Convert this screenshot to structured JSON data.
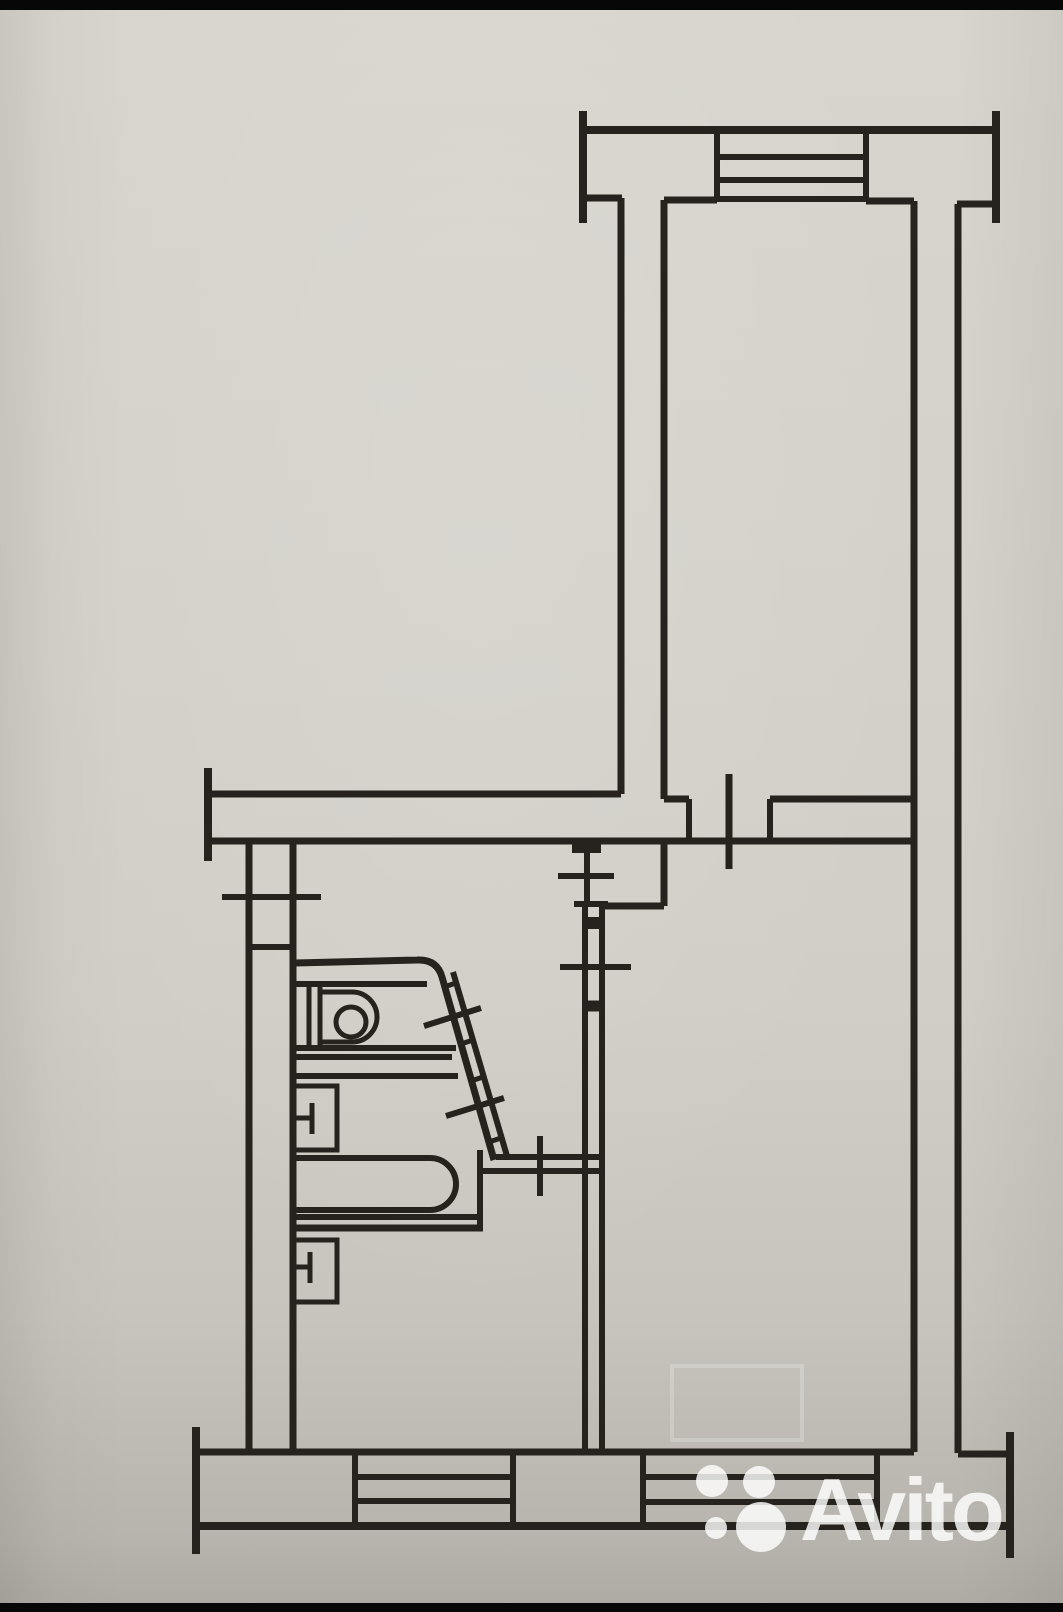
{
  "page": {
    "paper_color": "#d1cec7",
    "ink_color": "#26231e",
    "letterbox_color": "#070707"
  },
  "watermark": {
    "brand_text": "Avito",
    "text_color": "rgba(255,255,255,0.82)",
    "font_size_px": 88,
    "text_left_px": 800,
    "text_top_px": 1466,
    "dots": [
      {
        "name": "avito-dot-top-left",
        "cx": 712,
        "cy": 1481,
        "r": 16
      },
      {
        "name": "avito-dot-top-right",
        "cx": 759,
        "cy": 1482,
        "r": 16
      },
      {
        "name": "avito-dot-bottom-left",
        "cx": 716,
        "cy": 1528,
        "r": 11
      },
      {
        "name": "avito-dot-bottom-right",
        "cx": 761,
        "cy": 1527,
        "r": 25
      }
    ],
    "dot_color": "rgba(255,255,255,0.82)"
  },
  "floorplan": {
    "stroke": "#26231e",
    "elements": [
      {
        "type": "line",
        "name": "top-wall-outer",
        "x1": 583,
        "y1": 130,
        "x2": 997,
        "y2": 130,
        "w": 8
      },
      {
        "type": "line",
        "name": "top-wall-cap-left",
        "x1": 583,
        "y1": 111,
        "x2": 583,
        "y2": 223,
        "w": 8
      },
      {
        "type": "line",
        "name": "top-wall-cap-right",
        "x1": 996,
        "y1": 111,
        "x2": 996,
        "y2": 223,
        "w": 8
      },
      {
        "type": "line",
        "name": "top-wall-inner-a",
        "x1": 584,
        "y1": 198,
        "x2": 622,
        "y2": 198,
        "w": 7
      },
      {
        "type": "line",
        "name": "top-wall-inner-b",
        "x1": 664,
        "y1": 200,
        "x2": 717,
        "y2": 200,
        "w": 7
      },
      {
        "type": "line",
        "name": "window-top-jamb-left",
        "x1": 717,
        "y1": 132,
        "x2": 717,
        "y2": 199,
        "w": 6
      },
      {
        "type": "line",
        "name": "window-top-jamb-right",
        "x1": 866,
        "y1": 132,
        "x2": 866,
        "y2": 200,
        "w": 6
      },
      {
        "type": "line",
        "name": "window-top-line-1",
        "x1": 717,
        "y1": 157,
        "x2": 866,
        "y2": 157,
        "w": 6
      },
      {
        "type": "line",
        "name": "window-top-line-2",
        "x1": 717,
        "y1": 180,
        "x2": 866,
        "y2": 180,
        "w": 6
      },
      {
        "type": "line",
        "name": "window-top-sill",
        "x1": 717,
        "y1": 199,
        "x2": 866,
        "y2": 199,
        "w": 6
      },
      {
        "type": "line",
        "name": "top-wall-inner-c",
        "x1": 866,
        "y1": 201,
        "x2": 914,
        "y2": 201,
        "w": 7
      },
      {
        "type": "line",
        "name": "top-wall-inner-d",
        "x1": 957,
        "y1": 204,
        "x2": 994,
        "y2": 204,
        "w": 7
      },
      {
        "type": "line",
        "name": "room1-west-wall-outer",
        "x1": 621,
        "y1": 198,
        "x2": 621,
        "y2": 794,
        "w": 7
      },
      {
        "type": "line",
        "name": "room1-west-wall-inner",
        "x1": 664,
        "y1": 200,
        "x2": 664,
        "y2": 799,
        "w": 7
      },
      {
        "type": "line",
        "name": "east-wall-inner",
        "x1": 914,
        "y1": 201,
        "x2": 914,
        "y2": 1452,
        "w": 7
      },
      {
        "type": "line",
        "name": "east-wall-outer",
        "x1": 958,
        "y1": 204,
        "x2": 958,
        "y2": 1453,
        "w": 7
      },
      {
        "type": "line",
        "name": "mid-wall-cap-left",
        "x1": 208,
        "y1": 768,
        "x2": 208,
        "y2": 861,
        "w": 8
      },
      {
        "type": "line",
        "name": "mid-wall-top",
        "x1": 210,
        "y1": 794,
        "x2": 621,
        "y2": 794,
        "w": 7
      },
      {
        "type": "line",
        "name": "mid-wall-top-b",
        "x1": 664,
        "y1": 799,
        "x2": 689,
        "y2": 799,
        "w": 7
      },
      {
        "type": "line",
        "name": "mid-wall-top-c",
        "x1": 770,
        "y1": 799,
        "x2": 914,
        "y2": 799,
        "w": 7
      },
      {
        "type": "line",
        "name": "mid-wall-bottom",
        "x1": 210,
        "y1": 841,
        "x2": 914,
        "y2": 841,
        "w": 7
      },
      {
        "type": "line",
        "name": "doorway1-jamb-left",
        "x1": 689,
        "y1": 799,
        "x2": 689,
        "y2": 841,
        "w": 6
      },
      {
        "type": "line",
        "name": "doorway1-jamb-right",
        "x1": 770,
        "y1": 799,
        "x2": 770,
        "y2": 841,
        "w": 6
      },
      {
        "type": "line",
        "name": "doorway1-tick",
        "x1": 729,
        "y1": 774,
        "x2": 729,
        "y2": 869,
        "w": 7
      },
      {
        "type": "line",
        "name": "west-wall-outer",
        "x1": 249,
        "y1": 841,
        "x2": 249,
        "y2": 1452,
        "w": 7
      },
      {
        "type": "line",
        "name": "west-wall-inner",
        "x1": 293,
        "y1": 841,
        "x2": 293,
        "y2": 1452,
        "w": 7
      },
      {
        "type": "line",
        "name": "west-opening-tick",
        "x1": 222,
        "y1": 897,
        "x2": 321,
        "y2": 897,
        "w": 6
      },
      {
        "type": "line",
        "name": "west-opening-rung",
        "x1": 249,
        "y1": 947,
        "x2": 293,
        "y2": 947,
        "w": 6
      },
      {
        "type": "line",
        "name": "bottom-wall-cap-left",
        "x1": 196,
        "y1": 1427,
        "x2": 196,
        "y2": 1554,
        "w": 8
      },
      {
        "type": "line",
        "name": "bottom-wall-cap-right",
        "x1": 1010,
        "y1": 1432,
        "x2": 1010,
        "y2": 1558,
        "w": 8
      },
      {
        "type": "line",
        "name": "bottom-wall-inner",
        "x1": 197,
        "y1": 1452,
        "x2": 914,
        "y2": 1452,
        "w": 7
      },
      {
        "type": "line",
        "name": "bottom-wall-return",
        "x1": 958,
        "y1": 1454,
        "x2": 1008,
        "y2": 1454,
        "w": 7
      },
      {
        "type": "line",
        "name": "bottom-wall-outer",
        "x1": 196,
        "y1": 1526,
        "x2": 1009,
        "y2": 1526,
        "w": 8
      },
      {
        "type": "line",
        "name": "window-b1-jamb-left",
        "x1": 355,
        "y1": 1452,
        "x2": 355,
        "y2": 1526,
        "w": 6
      },
      {
        "type": "line",
        "name": "window-b1-jamb-right",
        "x1": 513,
        "y1": 1452,
        "x2": 513,
        "y2": 1526,
        "w": 6
      },
      {
        "type": "line",
        "name": "window-b1-line-1",
        "x1": 355,
        "y1": 1477,
        "x2": 513,
        "y2": 1477,
        "w": 6
      },
      {
        "type": "line",
        "name": "window-b1-line-2",
        "x1": 355,
        "y1": 1501,
        "x2": 513,
        "y2": 1501,
        "w": 6
      },
      {
        "type": "line",
        "name": "window-b2-jamb-left",
        "x1": 643,
        "y1": 1452,
        "x2": 643,
        "y2": 1526,
        "w": 6
      },
      {
        "type": "line",
        "name": "window-b2-jamb-right",
        "x1": 877,
        "y1": 1452,
        "x2": 877,
        "y2": 1526,
        "w": 6
      },
      {
        "type": "line",
        "name": "window-b2-line-1",
        "x1": 643,
        "y1": 1477,
        "x2": 877,
        "y2": 1477,
        "w": 6
      },
      {
        "type": "line",
        "name": "window-b2-line-2",
        "x1": 643,
        "y1": 1502,
        "x2": 877,
        "y2": 1502,
        "w": 6
      },
      {
        "type": "rect",
        "name": "partition-stub",
        "x": 572,
        "y": 840,
        "width": 29,
        "height": 13,
        "fill": "#26231e"
      },
      {
        "type": "line",
        "name": "closet-wall",
        "x1": 587,
        "y1": 853,
        "x2": 587,
        "y2": 904,
        "w": 6
      },
      {
        "type": "line",
        "name": "closet-opening-tick",
        "x1": 558,
        "y1": 876,
        "x2": 614,
        "y2": 876,
        "w": 6
      },
      {
        "type": "line",
        "name": "closet-jamb",
        "x1": 574,
        "y1": 904,
        "x2": 608,
        "y2": 904,
        "w": 6
      },
      {
        "type": "line",
        "name": "room2-west-wall-upper",
        "x1": 664,
        "y1": 841,
        "x2": 664,
        "y2": 906,
        "w": 7
      },
      {
        "type": "line",
        "name": "room2-wall-jog",
        "x1": 602,
        "y1": 906,
        "x2": 664,
        "y2": 906,
        "w": 7
      },
      {
        "type": "line",
        "name": "partition-west-line",
        "x1": 585,
        "y1": 906,
        "x2": 585,
        "y2": 1452,
        "w": 6
      },
      {
        "type": "line",
        "name": "partition-east-line",
        "x1": 602,
        "y1": 906,
        "x2": 602,
        "y2": 1452,
        "w": 6
      },
      {
        "type": "line",
        "name": "partition-rung-a",
        "x1": 585,
        "y1": 923,
        "x2": 602,
        "y2": 923,
        "w": 12
      },
      {
        "type": "line",
        "name": "doorway2-tick",
        "x1": 560,
        "y1": 967,
        "x2": 631,
        "y2": 967,
        "w": 6
      },
      {
        "type": "line",
        "name": "partition-rung-b",
        "x1": 585,
        "y1": 1006,
        "x2": 602,
        "y2": 1006,
        "w": 11
      },
      {
        "type": "path",
        "name": "bath-north-wall-and-diagonal",
        "d": "M295,963 L417,960 Q437,959 442,977 L494,1160",
        "w": 7
      },
      {
        "type": "line",
        "name": "bath-diagonal-inner",
        "x1": 453,
        "y1": 972,
        "x2": 507,
        "y2": 1156,
        "w": 6
      },
      {
        "type": "line",
        "name": "diagonal-rung-1",
        "x1": 444,
        "y1": 987,
        "x2": 456,
        "y2": 983,
        "w": 5
      },
      {
        "type": "line",
        "name": "diagonal-rung-2",
        "x1": 461,
        "y1": 1044,
        "x2": 473,
        "y2": 1040,
        "w": 5
      },
      {
        "type": "line",
        "name": "diagonal-rung-3",
        "x1": 471,
        "y1": 1081,
        "x2": 483,
        "y2": 1077,
        "w": 5
      },
      {
        "type": "line",
        "name": "diagonal-rung-4",
        "x1": 489,
        "y1": 1142,
        "x2": 501,
        "y2": 1138,
        "w": 5
      },
      {
        "type": "line",
        "name": "bath-door-tick-1",
        "x1": 424,
        "y1": 1026,
        "x2": 481,
        "y2": 1008,
        "w": 6
      },
      {
        "type": "line",
        "name": "bath-door-tick-2",
        "x1": 446,
        "y1": 1116,
        "x2": 504,
        "y2": 1098,
        "w": 6
      },
      {
        "type": "line",
        "name": "hall-kitchen-wall-top",
        "x1": 496,
        "y1": 1157,
        "x2": 602,
        "y2": 1157,
        "w": 6
      },
      {
        "type": "line",
        "name": "hall-kitchen-wall-bottom",
        "x1": 480,
        "y1": 1171,
        "x2": 602,
        "y2": 1171,
        "w": 6
      },
      {
        "type": "line",
        "name": "kitchen-door-tick",
        "x1": 540,
        "y1": 1136,
        "x2": 540,
        "y2": 1196,
        "w": 6
      },
      {
        "type": "line",
        "name": "fixture-shelf-line-1",
        "x1": 295,
        "y1": 1057,
        "x2": 452,
        "y2": 1057,
        "w": 6
      },
      {
        "type": "line",
        "name": "fixture-shelf-line-2",
        "x1": 295,
        "y1": 1076,
        "x2": 458,
        "y2": 1076,
        "w": 6
      },
      {
        "type": "line",
        "name": "unit-top",
        "x1": 296,
        "y1": 984,
        "x2": 427,
        "y2": 984,
        "w": 6
      },
      {
        "type": "line",
        "name": "unit-bottom",
        "x1": 296,
        "y1": 1048,
        "x2": 456,
        "y2": 1048,
        "w": 6
      },
      {
        "type": "line",
        "name": "unit-divider-1",
        "x1": 309,
        "y1": 984,
        "x2": 309,
        "y2": 1048,
        "w": 5
      },
      {
        "type": "line",
        "name": "unit-divider-2",
        "x1": 320,
        "y1": 984,
        "x2": 320,
        "y2": 1048,
        "w": 5
      },
      {
        "type": "path",
        "name": "unit-basin",
        "d": "M322,992 L352,992 A25,25 0 0 1 352,1042 L322,1042",
        "w": 5
      },
      {
        "type": "circle",
        "name": "unit-drain-circle",
        "cx": 351,
        "cy": 1022,
        "r": 15,
        "w": 5
      },
      {
        "type": "path",
        "name": "bathtub-basin",
        "d": "M294,1158 L430,1158 A26,26 0 0 1 430,1210 L294,1210",
        "w": 6
      },
      {
        "type": "line",
        "name": "tub-right-edge",
        "x1": 480,
        "y1": 1150,
        "x2": 480,
        "y2": 1228,
        "w": 6
      },
      {
        "type": "line",
        "name": "tub-bottom-edge",
        "x1": 294,
        "y1": 1217,
        "x2": 480,
        "y2": 1217,
        "w": 6
      },
      {
        "type": "line",
        "name": "kitchen-north-wall",
        "x1": 291,
        "y1": 1228,
        "x2": 483,
        "y2": 1228,
        "w": 7
      },
      {
        "type": "rect",
        "name": "appliance-1-outline",
        "x": 294,
        "y": 1086,
        "width": 43,
        "height": 64,
        "sw": 5
      },
      {
        "type": "line",
        "name": "appliance-1-t-horizontal",
        "x1": 294,
        "y1": 1118,
        "x2": 312,
        "y2": 1118,
        "w": 5
      },
      {
        "type": "line",
        "name": "appliance-1-t-vertical",
        "x1": 312,
        "y1": 1103,
        "x2": 312,
        "y2": 1134,
        "w": 5
      },
      {
        "type": "rect",
        "name": "appliance-2-outline",
        "x": 292,
        "y": 1240,
        "width": 45,
        "height": 62,
        "sw": 5
      },
      {
        "type": "line",
        "name": "appliance-2-t-horizontal",
        "x1": 292,
        "y1": 1267,
        "x2": 310,
        "y2": 1267,
        "w": 5
      },
      {
        "type": "line",
        "name": "appliance-2-t-vertical",
        "x1": 310,
        "y1": 1252,
        "x2": 310,
        "y2": 1283,
        "w": 5
      },
      {
        "type": "rect",
        "name": "ghost-smudge-rectangle",
        "x": 672,
        "y": 1366,
        "width": 130,
        "height": 74,
        "sw": 4,
        "color": "rgba(255,255,255,0.22)"
      }
    ]
  }
}
